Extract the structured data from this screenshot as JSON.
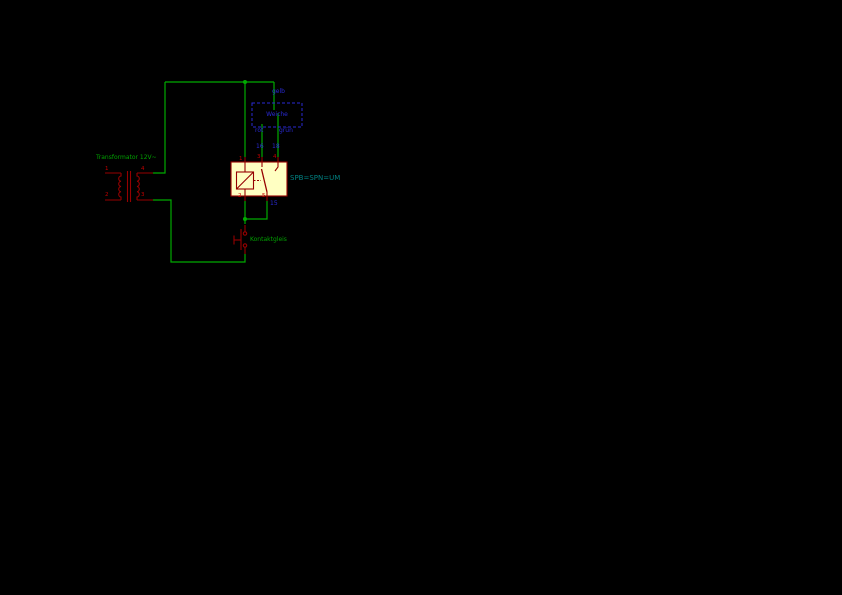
{
  "schematic": {
    "transformer": {
      "value": "Transformator 12V~",
      "pin_numbers": {
        "primary_top": "1",
        "primary_bottom": "2",
        "secondary_top": "4",
        "secondary_bottom": "3"
      }
    },
    "relay": {
      "value": "SPB=SPN=UM",
      "pin_numbers": {
        "coil_top": "1",
        "coil_bottom": "2",
        "contact_left": "3",
        "contact_right": "4",
        "common": "5"
      }
    },
    "turnout": {
      "name": "Weiche",
      "wire_labels": {
        "top": "gelb",
        "left": "rot",
        "right": "grün"
      }
    },
    "terminal_labels": {
      "left": "16",
      "right": "18",
      "common": "15"
    },
    "contact_track": {
      "value": "Kontaktgleis"
    },
    "colors": {
      "background": "#000000",
      "wire": "#00AA00",
      "symbol_outline": "#960000",
      "symbol_fill": "#FFFFC2",
      "pin_number_text": "#C00000",
      "field_text": "#00A000",
      "relay_value_text": "#008080",
      "note_text": "#2A2AD4"
    }
  }
}
